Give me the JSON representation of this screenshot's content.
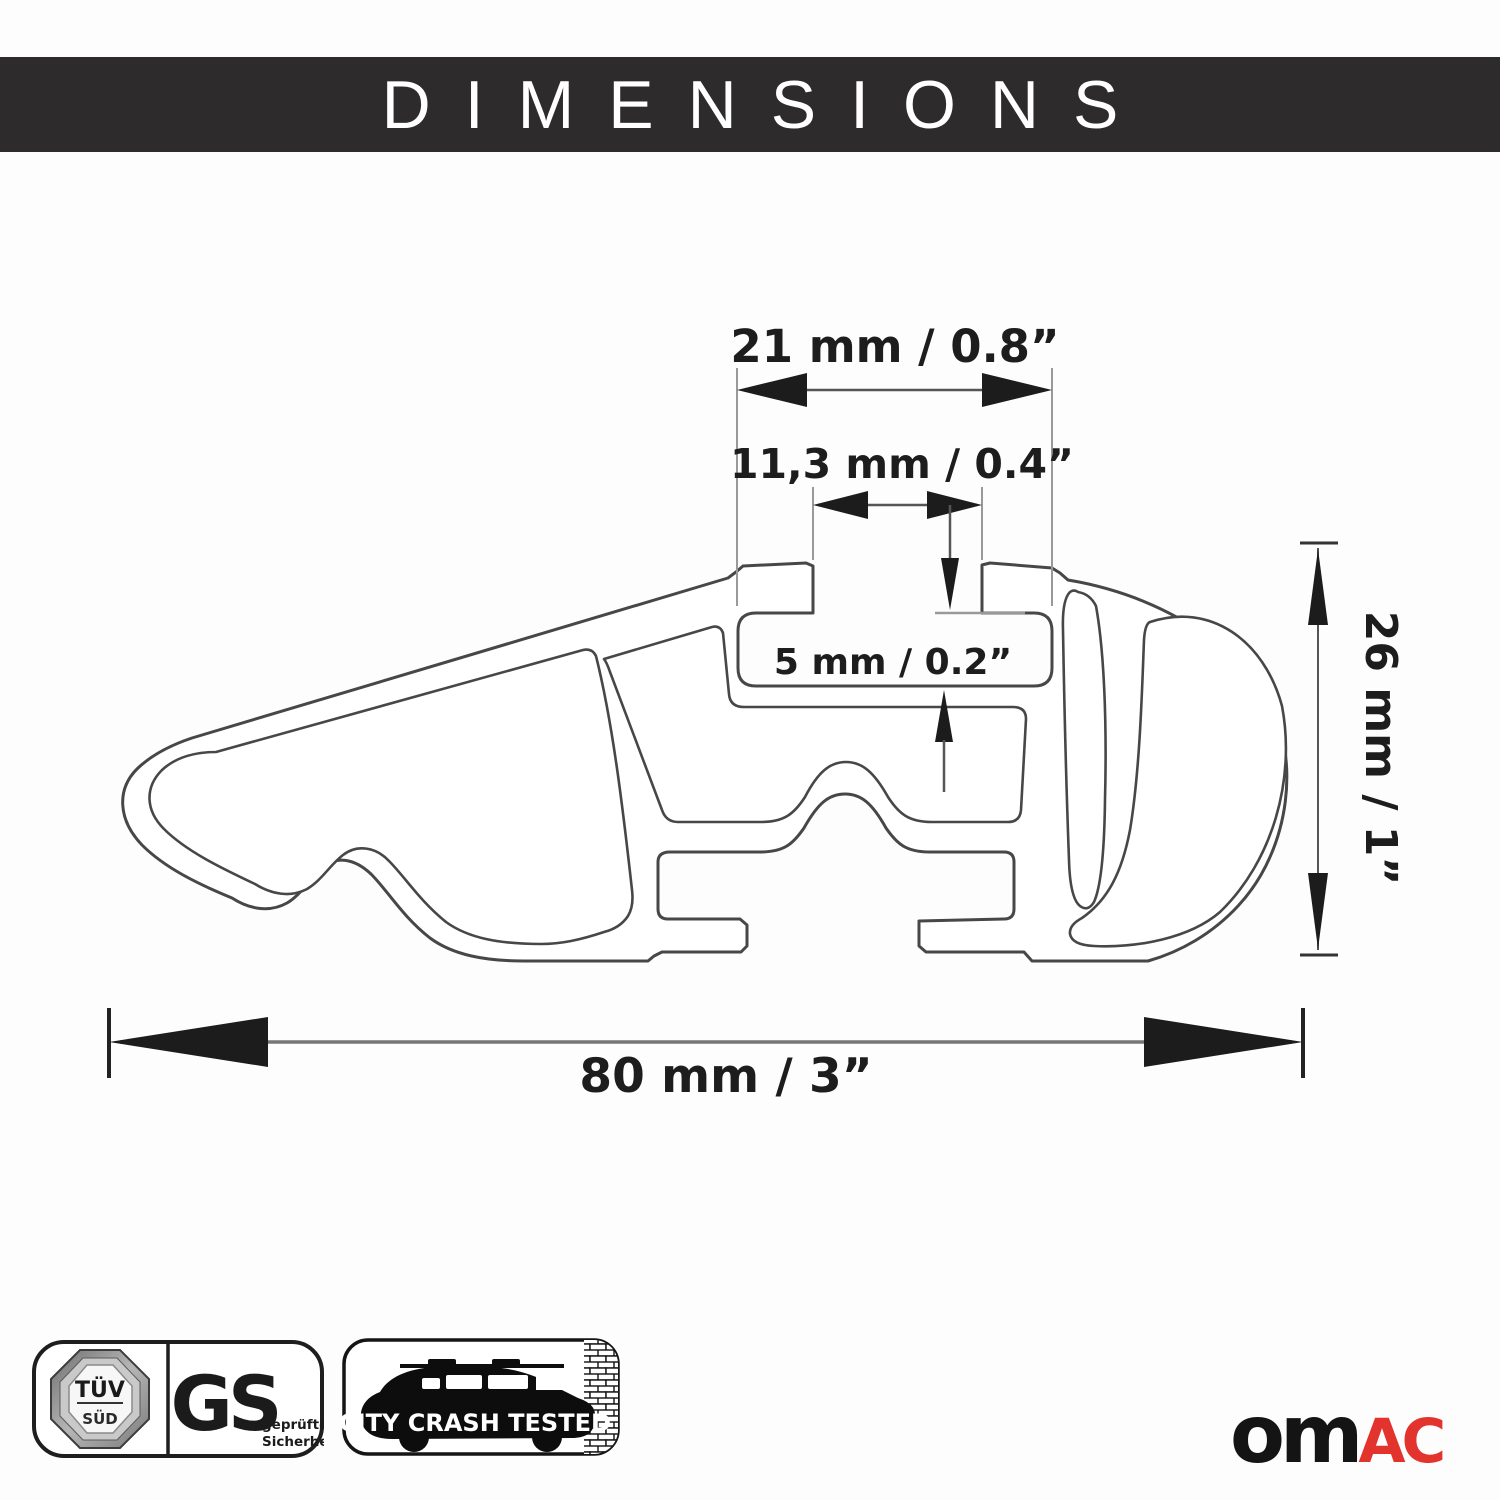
{
  "header": {
    "title": "DIMENSIONS"
  },
  "diagram": {
    "description": "cross-section of aluminum roof rack crossbar profile with dimension callouts",
    "labels": {
      "d21": "21 mm / 0.8”",
      "d113": "11,3 mm / 0.4”",
      "d5": "5 mm / 0.2”",
      "d26": "26 mm / 1”",
      "d80": "80 mm / 3”"
    }
  },
  "badges": {
    "tuv": {
      "top": "TÜV",
      "bottom": "SÜD"
    },
    "gs": {
      "big": "GS",
      "small_line1": "geprüfte",
      "small_line2": "Sicherheit"
    },
    "crash_test": {
      "label": "CITY CRASH TESTED"
    }
  },
  "brand": {
    "logo_black_part": "om",
    "logo_red_part": "AC"
  },
  "colors": {
    "header_bg": "#2d2b2c",
    "line": "#474747",
    "extension_line": "#999999",
    "arrow": "#1c1c1c",
    "accent_red": "#e2342d",
    "badge_gray": "#8f8f8f"
  }
}
